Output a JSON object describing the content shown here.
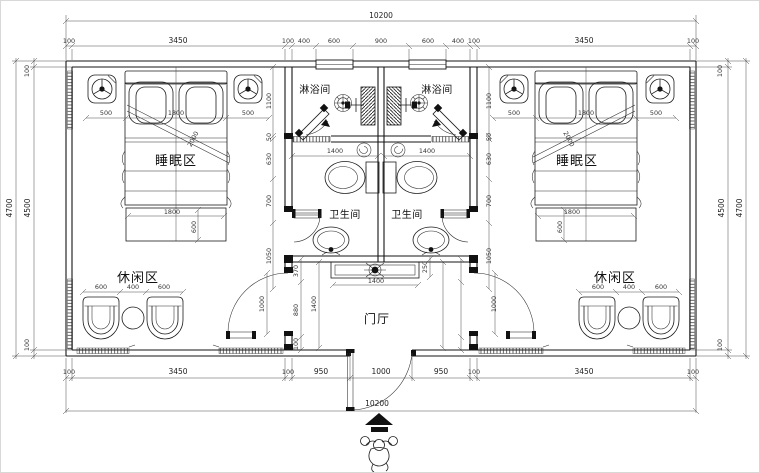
{
  "drawing": {
    "type": "floor-plan",
    "description": "Symmetric twin guest-room suite plan with central shower rooms, bathrooms and entrance hall"
  },
  "labels": {
    "shower": "淋浴间",
    "bath": "卫生间",
    "sleep": "睡眠区",
    "leisure": "休闲区",
    "hall": "门厅"
  },
  "dims": {
    "overall": "10200",
    "top_chain": [
      "100",
      "3450",
      "100",
      "400",
      "600",
      "900",
      "600",
      "400",
      "100",
      "3450",
      "100"
    ],
    "bottom_chain": [
      "100",
      "3450",
      "100",
      "950",
      "1000",
      "950",
      "100",
      "3450",
      "100"
    ],
    "side_outer": "4700",
    "side_inner": "4500",
    "wall": "100",
    "bed": [
      "500",
      "1800",
      "500"
    ],
    "bed_diag": "2000",
    "bench": [
      "1800",
      "600"
    ],
    "chairs": [
      "600",
      "400",
      "600"
    ],
    "bath_width": "1400",
    "console_width": "1400",
    "console_depth": "250",
    "hall_height": "1400",
    "hall_chain": [
      "370",
      "880",
      "100"
    ],
    "side_chain": [
      "1100",
      "50",
      "630",
      "700",
      "1050"
    ],
    "door_width": "1000"
  }
}
